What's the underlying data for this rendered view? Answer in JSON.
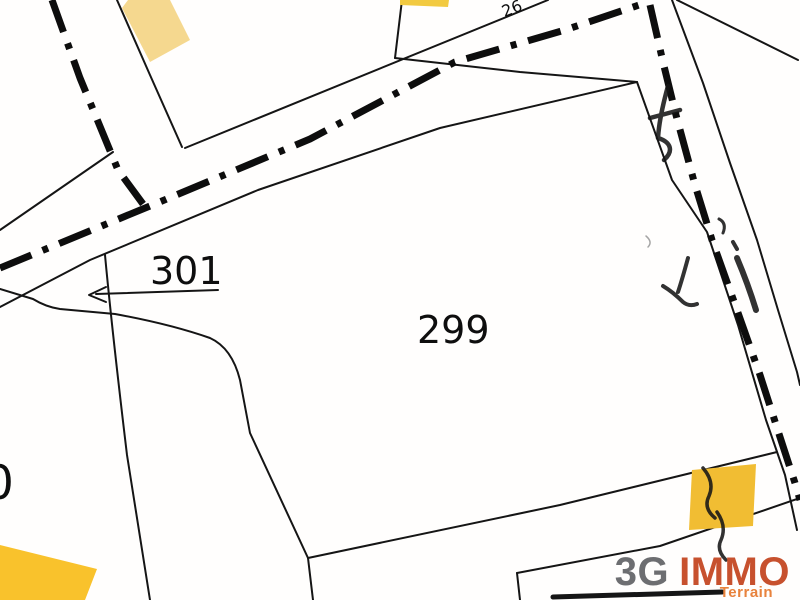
{
  "map": {
    "type": "cadastral-parcel-map",
    "labels": {
      "parcel_299": "299",
      "parcel_301": "301",
      "parcel_left_partial": "0",
      "road_number": "26"
    },
    "colors": {
      "background": "#fffefd",
      "line": "#151515",
      "boundary_dashdot": "#0d0d0d",
      "building_pale_yellow": "#f5d88f",
      "building_yellow": "#f2ca41",
      "building_gold": "#f1bd33",
      "building_deep_gold": "#f9c22c"
    }
  },
  "watermark": {
    "prefix": "3G",
    "name": "IMMO",
    "subtitle": "Terrain",
    "prefix_color": "#6d6e71",
    "name_color": "#c7512e",
    "subtitle_color": "#e8823c"
  }
}
